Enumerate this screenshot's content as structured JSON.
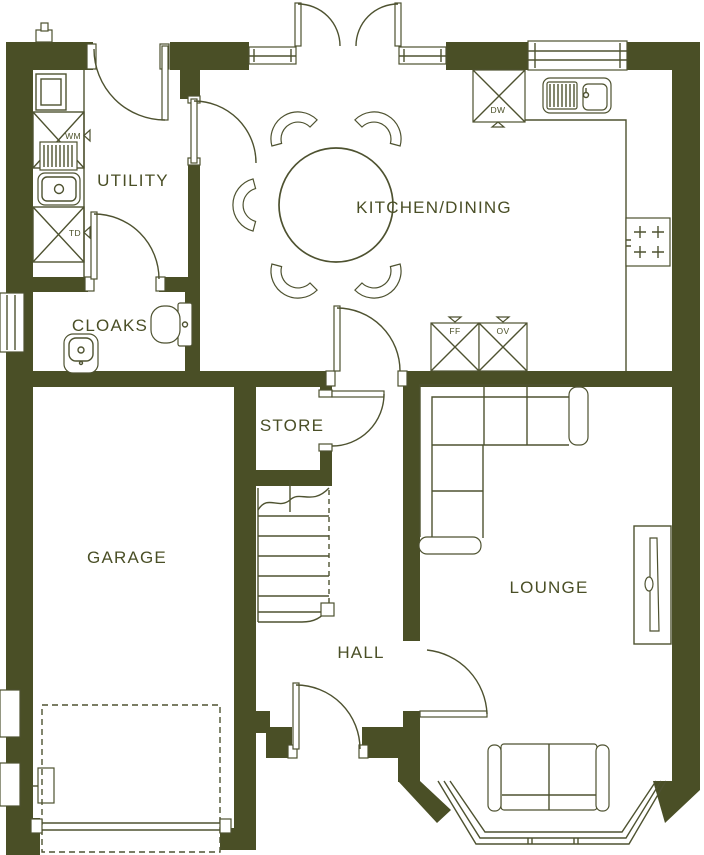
{
  "plan": {
    "rooms": {
      "utility": "UTILITY",
      "kitchen_dining": "KITCHEN/DINING",
      "cloaks": "CLOAKS",
      "store": "STORE",
      "garage": "GARAGE",
      "lounge": "LOUNGE",
      "hall": "HALL"
    },
    "appliances": {
      "washing_machine": "WM",
      "tumble_dryer": "TD",
      "dishwasher": "DW",
      "fridge_freezer": "FF",
      "oven": "OV"
    },
    "colors": {
      "wall": "#4a4f26",
      "line": "#4e5230",
      "text": "#4a4f26",
      "background": "#ffffff"
    }
  }
}
